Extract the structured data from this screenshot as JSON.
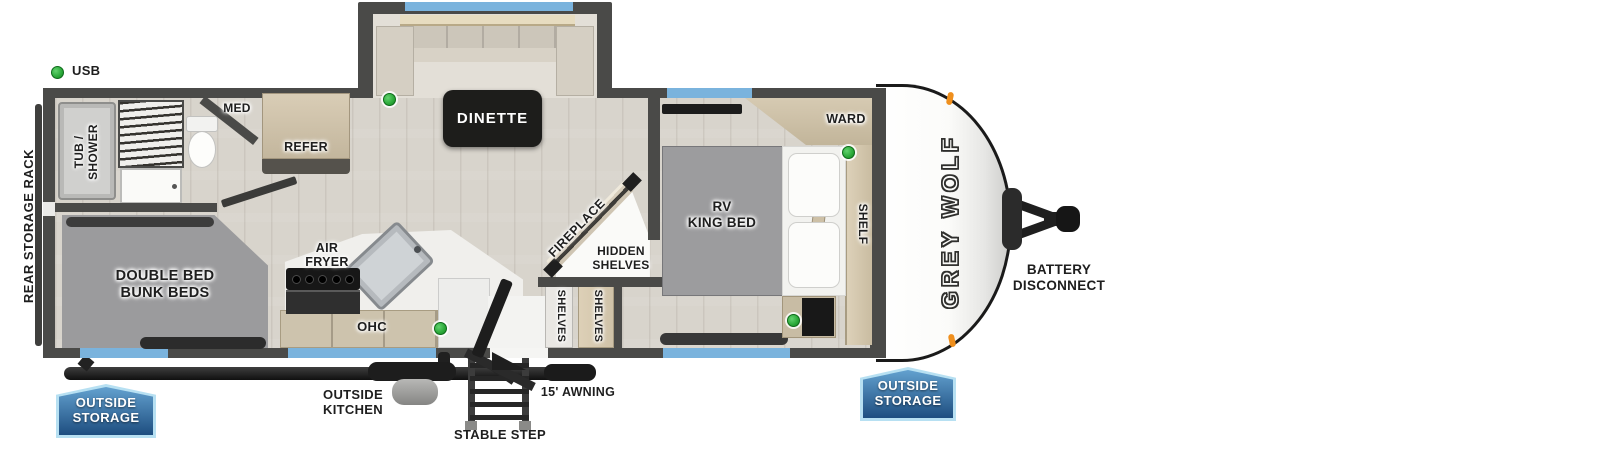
{
  "legend": {
    "usb_label": "USB"
  },
  "brand": {
    "logo_text": "GREY WOLF"
  },
  "rooms": {
    "tub_shower": "TUB /\nSHOWER",
    "med": "MED",
    "refer": "REFER",
    "dinette": "DINETTE",
    "fireplace": "FIREPLACE",
    "hidden_shelves": "HIDDEN\nSHELVES",
    "shelves": "SHELVES",
    "rv_king_bed": "RV\nKING BED",
    "ward": "WARD",
    "shelf": "SHELF",
    "double_bed_bunk_beds": "DOUBLE BED\nBUNK BEDS",
    "air_fryer": "AIR\nFRYER",
    "ohc": "OHC"
  },
  "exterior": {
    "rear_storage_rack": "REAR STORAGE RACK",
    "outside_storage": "OUTSIDE\nSTORAGE",
    "outside_kitchen": "OUTSIDE\nKITCHEN",
    "stable_step": "STABLE STEP",
    "awning": "15' AWNING",
    "battery_disconnect": "BATTERY\nDISCONNECT"
  },
  "colors": {
    "usb_green": "#2aa838",
    "badge_blue": "#1e4e80",
    "window_blue": "#7ab3dd",
    "wall_gray": "#4a4a48",
    "wood_tan": "#cfc3ab"
  }
}
